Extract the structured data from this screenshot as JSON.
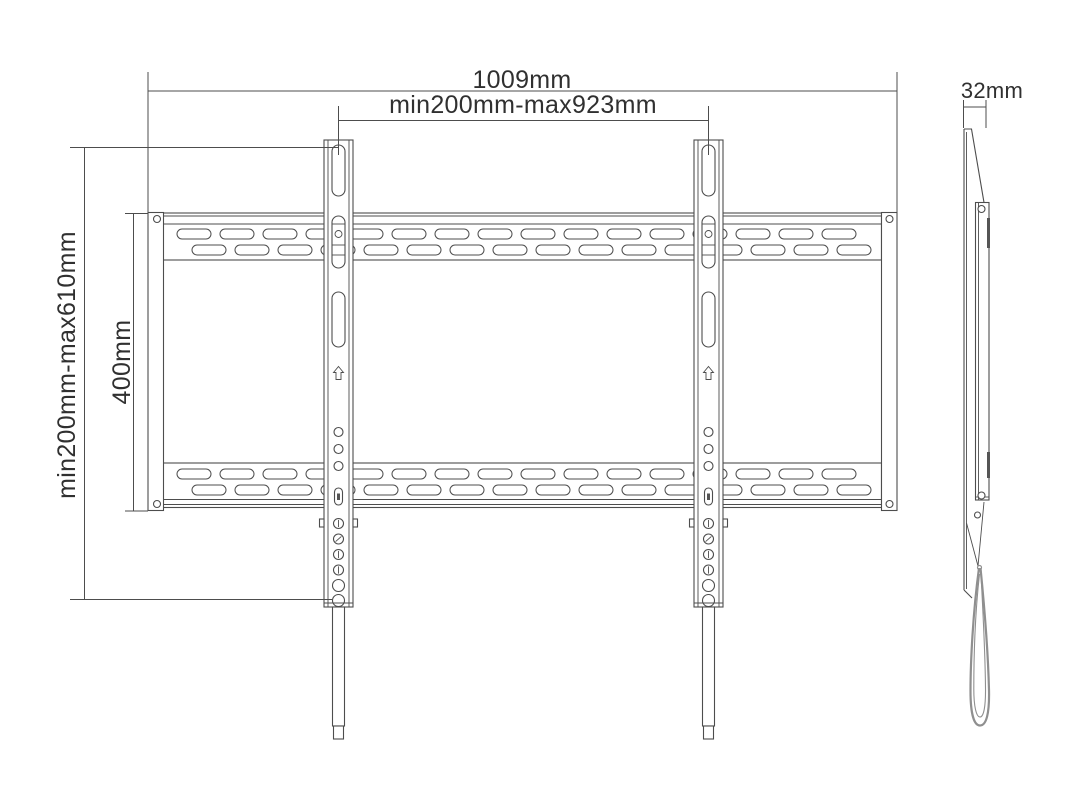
{
  "labels": {
    "overall_width": "1009mm",
    "horizontal_hole_range": "min200mm-max923mm",
    "vertical_hole_range": "min200mm-max610mm",
    "plate_height": "400mm",
    "depth": "32mm"
  },
  "colors": {
    "line": "#4d4d4d",
    "text": "#303030",
    "strap": "#8f8f8f",
    "background": "#ffffff"
  }
}
